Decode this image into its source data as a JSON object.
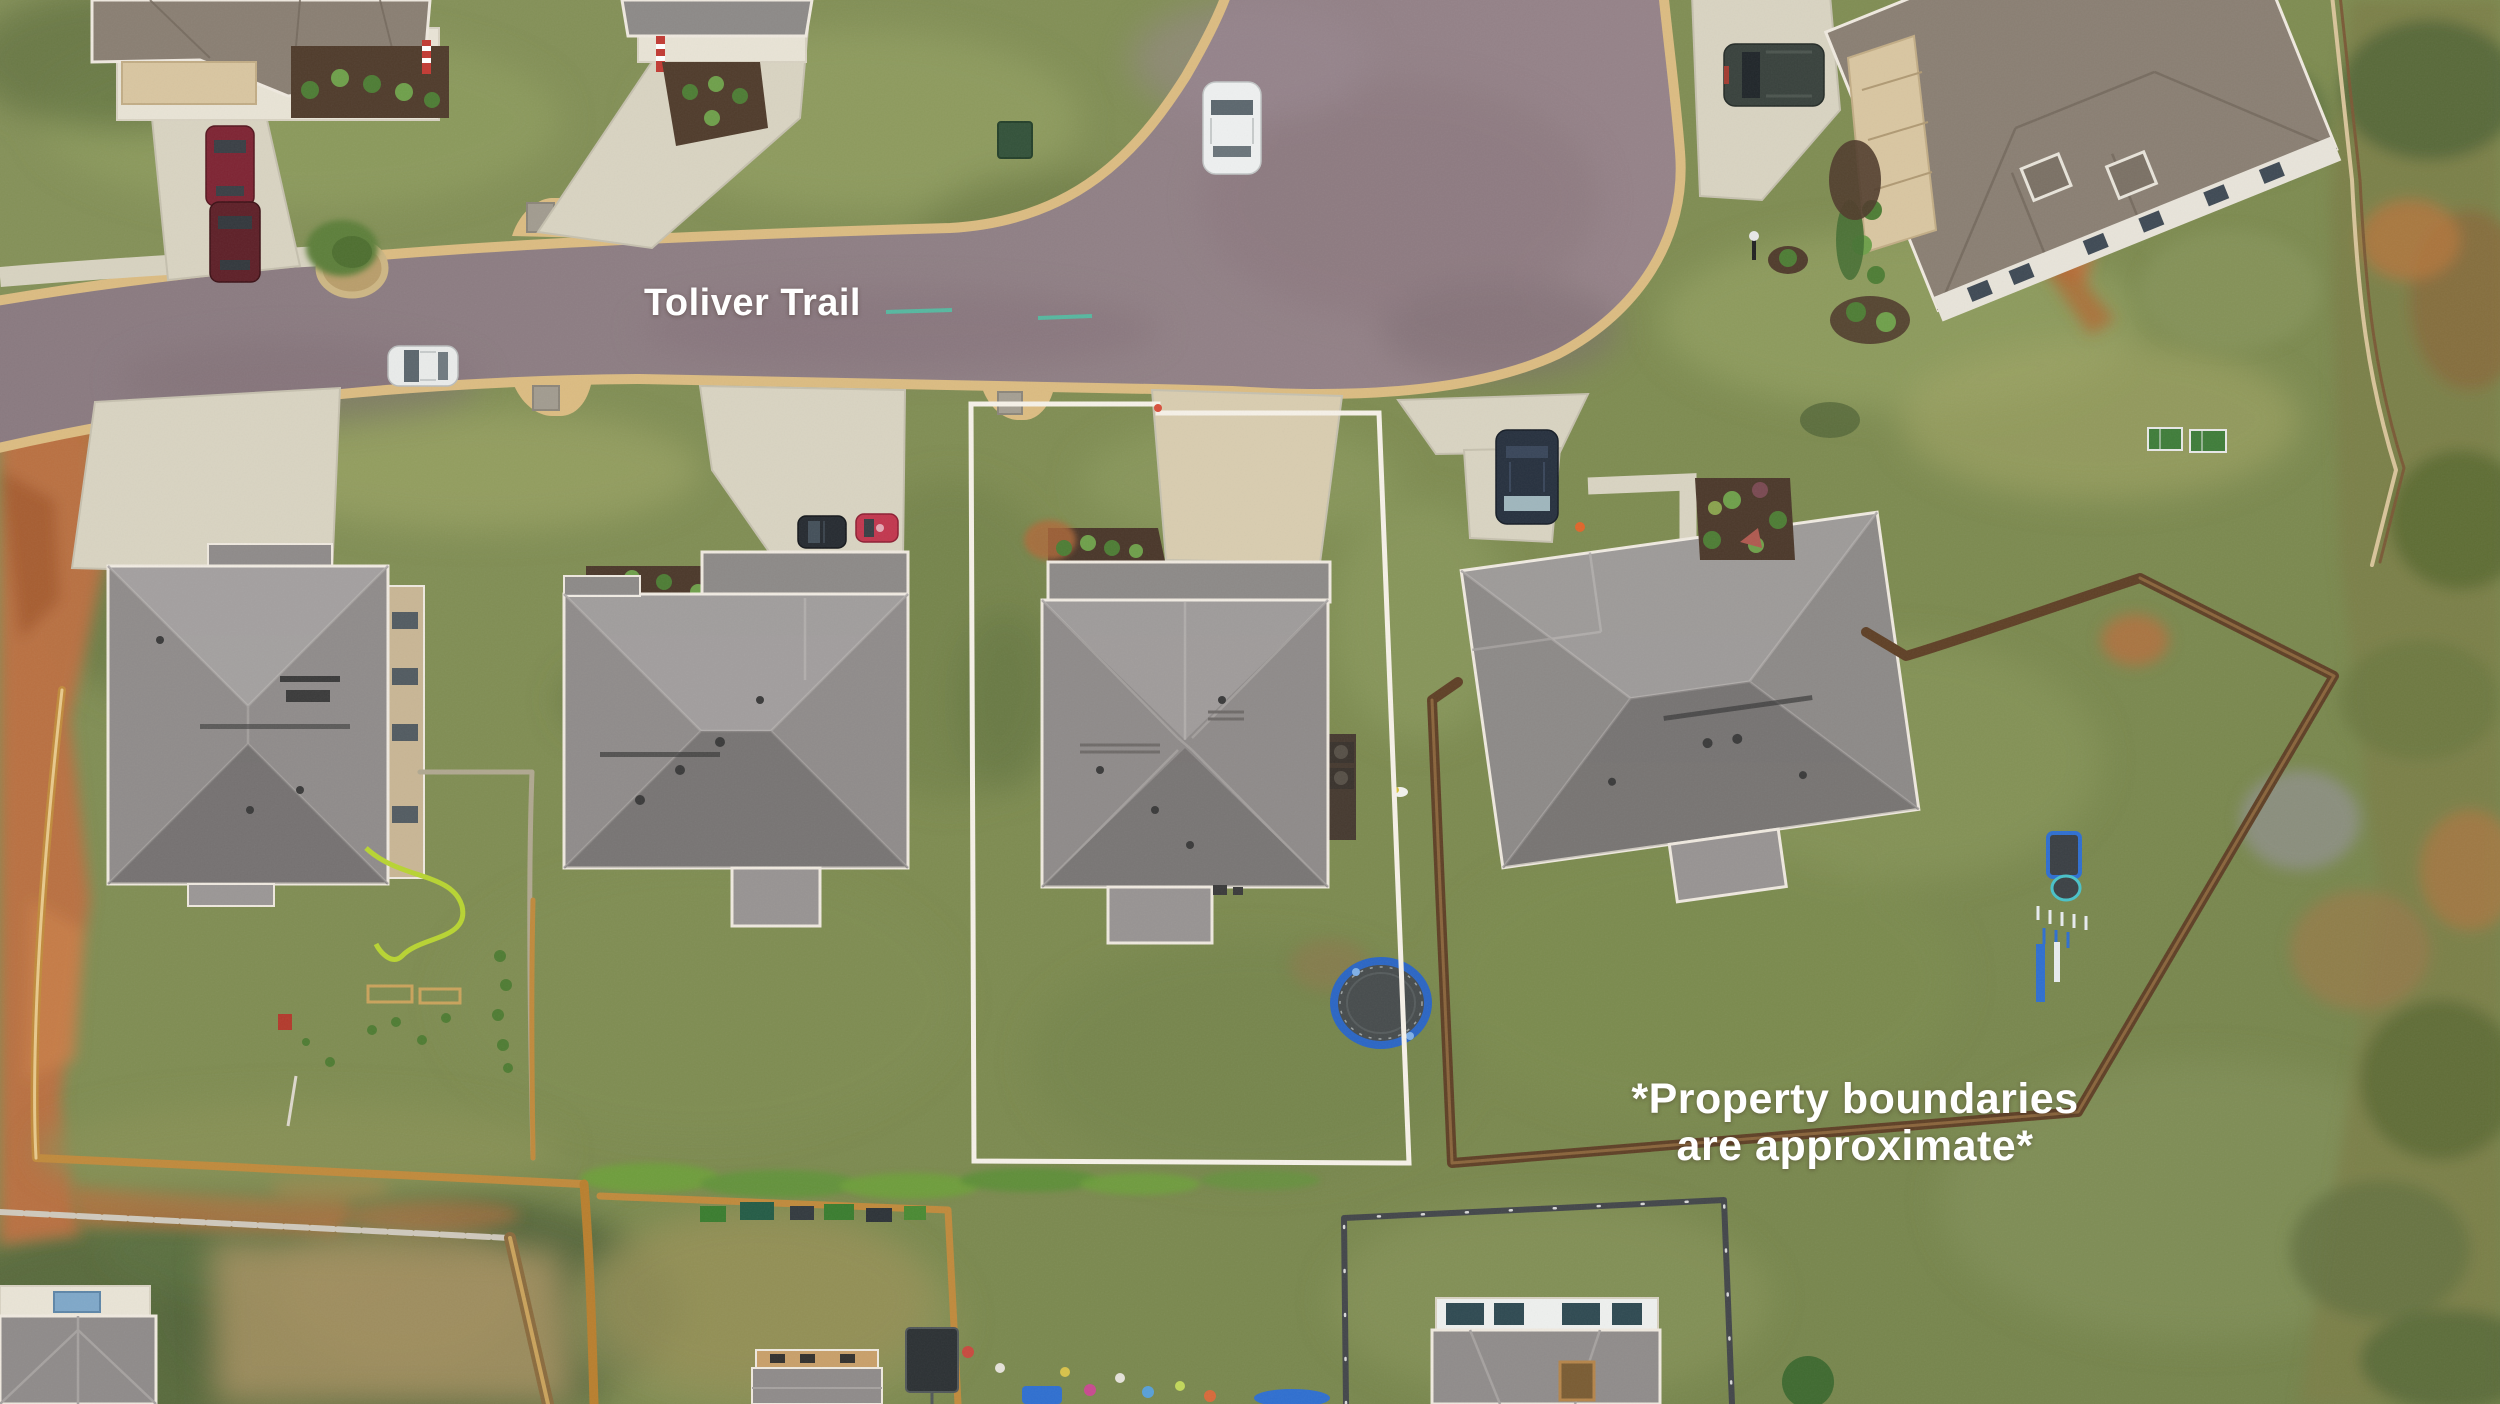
{
  "page": {
    "kind": "aerial-drone-real-estate-photo",
    "width_px": 2500,
    "height_px": 1404
  },
  "annotations": {
    "street_label": {
      "text": "Toliver Trail",
      "color": "#ffffff"
    },
    "disclaimer": {
      "line1": "*Property boundaries",
      "line2": "are approximate*",
      "color": "#ffffff"
    }
  },
  "scene": {
    "description": "Top-down drone view of a suburban cul-de-sac street with a row of gray hip-roof houses; the subject lot is outlined in white",
    "road": {
      "name": "Toliver Trail",
      "surface_color": "#8e7e84",
      "curb_color": "#dcbc82",
      "shape": "street curving from left into a large cul-de-sac knuckle with a branch exiting top of frame"
    },
    "highlighted_lot": {
      "outline_color": "#f6f1e8",
      "contents": [
        "gray hip-roof house",
        "tan concrete driveway",
        "front shrub bed",
        "backyard trampoline"
      ]
    },
    "houses": [
      {
        "name": "house-left",
        "roof_color": "#908c8b",
        "wall_color": "#c9b695"
      },
      {
        "name": "house-second",
        "roof_color": "#908c8b",
        "front_bed": "dark mulch with green shrubs"
      },
      {
        "name": "house-subject",
        "roof_color": "#8f8b8a",
        "inside_boundary": true
      },
      {
        "name": "house-right",
        "roof_color": "#8d8a88",
        "rotated": true,
        "fenced_backyard": true
      },
      {
        "name": "house-top-left",
        "roof_color": "#8a7f73"
      },
      {
        "name": "house-top-center",
        "roof_color": "#8d8a88"
      },
      {
        "name": "house-top-right",
        "roof_color": "#8a7f73",
        "wall_color": "#e8e4da"
      },
      {
        "name": "house-bottom-left-partial",
        "roof_color": "#8f8b8a"
      },
      {
        "name": "house-bottom-center-partial",
        "wall_color": "#c9a06a"
      },
      {
        "name": "house-bottom-right-partial",
        "wall_color": "#eef0ee"
      }
    ],
    "vehicles": [
      {
        "name": "white-car-on-street",
        "color": "#e9ebea"
      },
      {
        "name": "white-car-in-culdesac",
        "color": "#eef0f0"
      },
      {
        "name": "maroon-suv-top-left-driveway",
        "color": "#7e2433"
      },
      {
        "name": "dark-car-top-left-driveway",
        "color": "#5e2028"
      },
      {
        "name": "black-car-second-driveway",
        "color": "#262b31"
      },
      {
        "name": "red-car-second-driveway",
        "color": "#c2374e"
      },
      {
        "name": "blue-suv-right-driveway",
        "color": "#27313f"
      },
      {
        "name": "dark-suv-top-right-driveway",
        "color": "#39423d"
      }
    ],
    "objects": [
      {
        "name": "trampoline",
        "ring_color": "#2b66c4",
        "mat_color": "#474c4d"
      },
      {
        "name": "playset",
        "colors": [
          "#2f6fd0",
          "#e8ecef"
        ]
      },
      {
        "name": "garden-hose",
        "color": "#b8d432"
      },
      {
        "name": "utility-box",
        "color": "#33523a"
      },
      {
        "name": "wood-fences",
        "color": "#c08a3c"
      },
      {
        "name": "dark-backyard-fence",
        "color": "#5f4026"
      },
      {
        "name": "black-metal-fence",
        "color": "#43464a"
      },
      {
        "name": "red-clay-patches",
        "color": "#bd7040"
      },
      {
        "name": "trampoline-lot-grass",
        "color": "#7e8c51"
      }
    ]
  }
}
